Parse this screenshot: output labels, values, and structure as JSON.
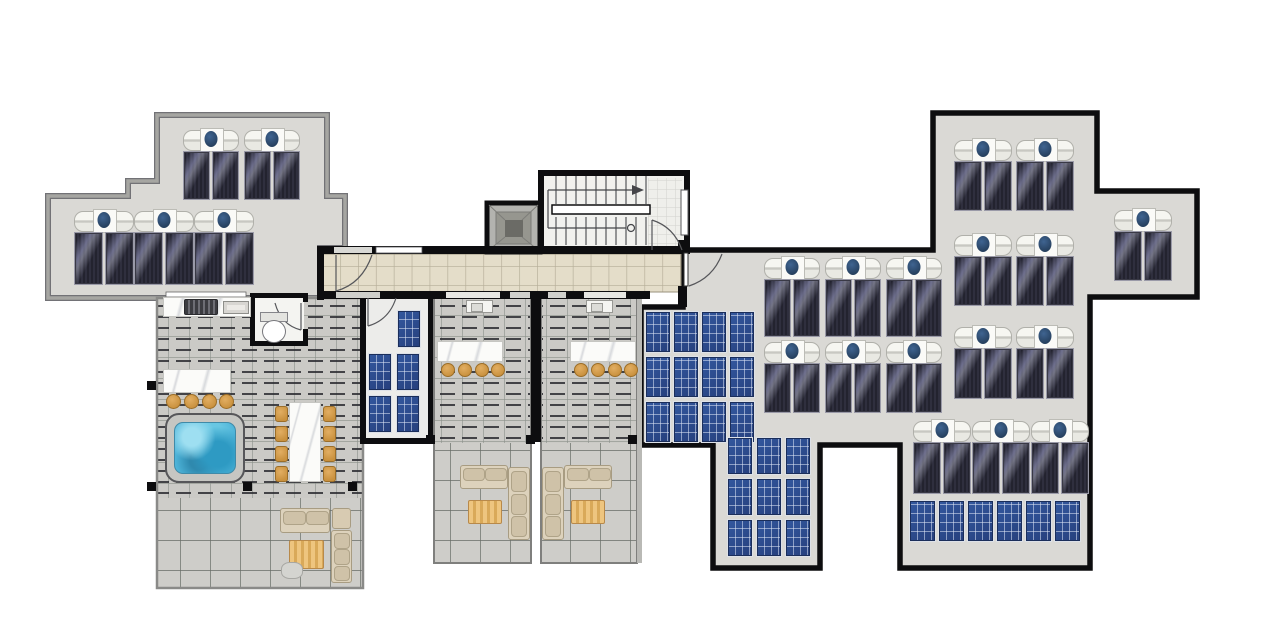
{
  "meta": {
    "title": "",
    "drawing_type": "architectural roof / penthouse terrace plan, top view, no text labels"
  },
  "palette": {
    "background": "#ffffff",
    "roof_concrete": "#dad9d5",
    "outer_wall_black": "#0d0d0f",
    "light_roof_border": "#a6a6a2",
    "corridor_tile": "#e4ddc9",
    "terrace_tile": "#cbcac6",
    "pergola_slat": "#2b2b30",
    "thermal_panel_dark": "#282834",
    "pv_panel_blue": "#2d4f95",
    "heater_tank_white": "#fafaf7",
    "heater_dot_blue": "#2c4c77",
    "marble_white": "#fbfbf9",
    "wood_tan": "#cf9a4b",
    "jacuzzi_water": "#4db3d8",
    "sofa_beige": "#ddd2bc"
  },
  "summary": {
    "solar_water_heater_units": 21,
    "solar_thermal_panels": 42,
    "pv_panels": 32,
    "terraces": 3,
    "jacuzzi_count": 1,
    "stairwells": 1,
    "elevators": 1
  },
  "equipment": {
    "solar_heater_clusters": [
      {
        "x": 183,
        "y": 128,
        "units": 2,
        "stride": 61,
        "pw": 27,
        "ph": 49
      },
      {
        "x": 74,
        "y": 209,
        "units": 3,
        "stride": 60,
        "pw": 29,
        "ph": 53
      },
      {
        "x": 764,
        "y": 256,
        "units": 3,
        "stride": 61,
        "pw": 27,
        "ph": 58
      },
      {
        "x": 764,
        "y": 340,
        "units": 3,
        "stride": 61,
        "pw": 27,
        "ph": 50
      },
      {
        "x": 954,
        "y": 138,
        "units": 2,
        "stride": 62,
        "pw": 28,
        "ph": 50
      },
      {
        "x": 954,
        "y": 233,
        "units": 2,
        "stride": 62,
        "pw": 28,
        "ph": 50
      },
      {
        "x": 954,
        "y": 325,
        "units": 2,
        "stride": 62,
        "pw": 28,
        "ph": 51
      },
      {
        "x": 913,
        "y": 419,
        "units": 3,
        "stride": 59,
        "pw": 28,
        "ph": 52
      },
      {
        "x": 1114,
        "y": 208,
        "units": 1,
        "stride": 61,
        "pw": 28,
        "ph": 50
      }
    ],
    "pv_arrays": [
      {
        "x": 645,
        "y": 311,
        "cols": 4,
        "rows": 3,
        "pw": 26,
        "ph": 42,
        "gx": 2,
        "gy": 3
      },
      {
        "x": 727,
        "y": 437,
        "cols": 3,
        "rows": 3,
        "pw": 26,
        "ph": 38,
        "gx": 3,
        "gy": 3
      },
      {
        "x": 909,
        "y": 500,
        "cols": 6,
        "rows": 1,
        "pw": 27,
        "ph": 42,
        "gx": 2,
        "gy": 2
      }
    ],
    "pv_panels_single": [
      {
        "x": 397,
        "y": 310,
        "w": 24,
        "h": 38
      },
      {
        "x": 368,
        "y": 353,
        "w": 24,
        "h": 38
      },
      {
        "x": 396,
        "y": 353,
        "w": 24,
        "h": 38
      },
      {
        "x": 368,
        "y": 395,
        "w": 24,
        "h": 38
      },
      {
        "x": 396,
        "y": 395,
        "w": 24,
        "h": 38
      }
    ]
  },
  "furniture": {
    "items": [
      {
        "type": "counter-marble",
        "name": "outdoor-kitchen-counter",
        "x": 163,
        "y": 297,
        "w": 88,
        "h": 20
      },
      {
        "type": "grill",
        "name": "bbq-grill",
        "x": 184,
        "y": 299,
        "w": 34,
        "h": 16
      },
      {
        "type": "sink-small",
        "name": "kitchen-sink",
        "x": 223,
        "y": 301,
        "w": 26,
        "h": 13
      },
      {
        "type": "toilet",
        "name": "wc-toilet",
        "x": 260,
        "y": 312,
        "w": 26,
        "h": 30
      },
      {
        "type": "bar-marble",
        "name": "jacuzzi-bar-counter",
        "x": 163,
        "y": 369,
        "w": 68,
        "h": 24
      },
      {
        "type": "stool",
        "name": "bar-stool",
        "x": 166,
        "y": 394,
        "w": 15,
        "h": 15
      },
      {
        "type": "stool",
        "name": "bar-stool",
        "x": 184,
        "y": 394,
        "w": 15,
        "h": 15
      },
      {
        "type": "stool",
        "name": "bar-stool",
        "x": 202,
        "y": 394,
        "w": 15,
        "h": 15
      },
      {
        "type": "stool",
        "name": "bar-stool",
        "x": 219,
        "y": 394,
        "w": 15,
        "h": 15
      },
      {
        "type": "jacuzzi",
        "name": "jacuzzi-hot-tub",
        "x": 165,
        "y": 413,
        "w": 80,
        "h": 70
      },
      {
        "type": "table-marble",
        "name": "dining-table",
        "x": 289,
        "y": 402,
        "w": 32,
        "h": 80
      },
      {
        "type": "chair",
        "name": "dining-chair",
        "x": 275,
        "y": 406,
        "w": 13,
        "h": 16
      },
      {
        "type": "chair",
        "name": "dining-chair",
        "x": 275,
        "y": 426,
        "w": 13,
        "h": 16
      },
      {
        "type": "chair",
        "name": "dining-chair",
        "x": 275,
        "y": 446,
        "w": 13,
        "h": 16
      },
      {
        "type": "chair",
        "name": "dining-chair",
        "x": 275,
        "y": 466,
        "w": 13,
        "h": 16
      },
      {
        "type": "chair",
        "name": "dining-chair",
        "x": 323,
        "y": 406,
        "w": 13,
        "h": 16
      },
      {
        "type": "chair",
        "name": "dining-chair",
        "x": 323,
        "y": 426,
        "w": 13,
        "h": 16
      },
      {
        "type": "chair",
        "name": "dining-chair",
        "x": 323,
        "y": 446,
        "w": 13,
        "h": 16
      },
      {
        "type": "chair",
        "name": "dining-chair",
        "x": 323,
        "y": 466,
        "w": 13,
        "h": 16
      },
      {
        "type": "sofa-h",
        "name": "sofa",
        "x": 280,
        "y": 508,
        "w": 50,
        "h": 25
      },
      {
        "type": "sofa-corner",
        "name": "sofa-corner",
        "x": 332,
        "y": 508,
        "w": 19,
        "h": 21
      },
      {
        "type": "sofa-v",
        "name": "sofa",
        "x": 331,
        "y": 530,
        "w": 21,
        "h": 53
      },
      {
        "type": "rattan-table",
        "name": "rattan-coffee-table",
        "x": 289,
        "y": 540,
        "w": 35,
        "h": 29
      },
      {
        "type": "pouf",
        "name": "pouf",
        "x": 281,
        "y": 562,
        "w": 22,
        "h": 17
      },
      {
        "type": "sink-marker",
        "name": "terrace-sink",
        "x": 466,
        "y": 300,
        "w": 27,
        "h": 13
      },
      {
        "type": "bar-marble",
        "name": "terrace-bar-counter",
        "x": 437,
        "y": 341,
        "w": 66,
        "h": 21
      },
      {
        "type": "stool",
        "name": "bar-stool",
        "x": 441,
        "y": 363,
        "w": 14,
        "h": 14
      },
      {
        "type": "stool",
        "name": "bar-stool",
        "x": 458,
        "y": 363,
        "w": 14,
        "h": 14
      },
      {
        "type": "stool",
        "name": "bar-stool",
        "x": 475,
        "y": 363,
        "w": 14,
        "h": 14
      },
      {
        "type": "stool",
        "name": "bar-stool",
        "x": 491,
        "y": 363,
        "w": 14,
        "h": 14
      },
      {
        "type": "sofa-h",
        "name": "sofa",
        "x": 460,
        "y": 465,
        "w": 48,
        "h": 24
      },
      {
        "type": "sofa-v",
        "name": "sofa",
        "x": 508,
        "y": 467,
        "w": 22,
        "h": 73
      },
      {
        "type": "rattan-table",
        "name": "rattan-coffee-table",
        "x": 468,
        "y": 500,
        "w": 34,
        "h": 24
      },
      {
        "type": "sink-marker",
        "name": "terrace-sink",
        "x": 586,
        "y": 300,
        "w": 27,
        "h": 13
      },
      {
        "type": "bar-marble",
        "name": "terrace-bar-counter",
        "x": 570,
        "y": 341,
        "w": 66,
        "h": 21
      },
      {
        "type": "stool",
        "name": "bar-stool",
        "x": 574,
        "y": 363,
        "w": 14,
        "h": 14
      },
      {
        "type": "stool",
        "name": "bar-stool",
        "x": 591,
        "y": 363,
        "w": 14,
        "h": 14
      },
      {
        "type": "stool",
        "name": "bar-stool",
        "x": 608,
        "y": 363,
        "w": 14,
        "h": 14
      },
      {
        "type": "stool",
        "name": "bar-stool",
        "x": 624,
        "y": 363,
        "w": 14,
        "h": 14
      },
      {
        "type": "sofa-v",
        "name": "sofa",
        "x": 542,
        "y": 467,
        "w": 22,
        "h": 73
      },
      {
        "type": "sofa-h",
        "name": "sofa",
        "x": 564,
        "y": 465,
        "w": 48,
        "h": 24
      },
      {
        "type": "rattan-table",
        "name": "rattan-coffee-table",
        "x": 571,
        "y": 500,
        "w": 34,
        "h": 24
      }
    ]
  },
  "posts": [
    [
      151,
      385
    ],
    [
      151,
      486
    ],
    [
      247,
      486
    ],
    [
      352,
      486
    ],
    [
      430,
      439
    ],
    [
      530,
      439
    ],
    [
      632,
      439
    ]
  ],
  "stairs": {
    "tread_x_start": 556,
    "tread_x_end": 646,
    "tread_step": 10,
    "flight1": [
      176,
      204
    ],
    "flight2": [
      217,
      245
    ]
  }
}
